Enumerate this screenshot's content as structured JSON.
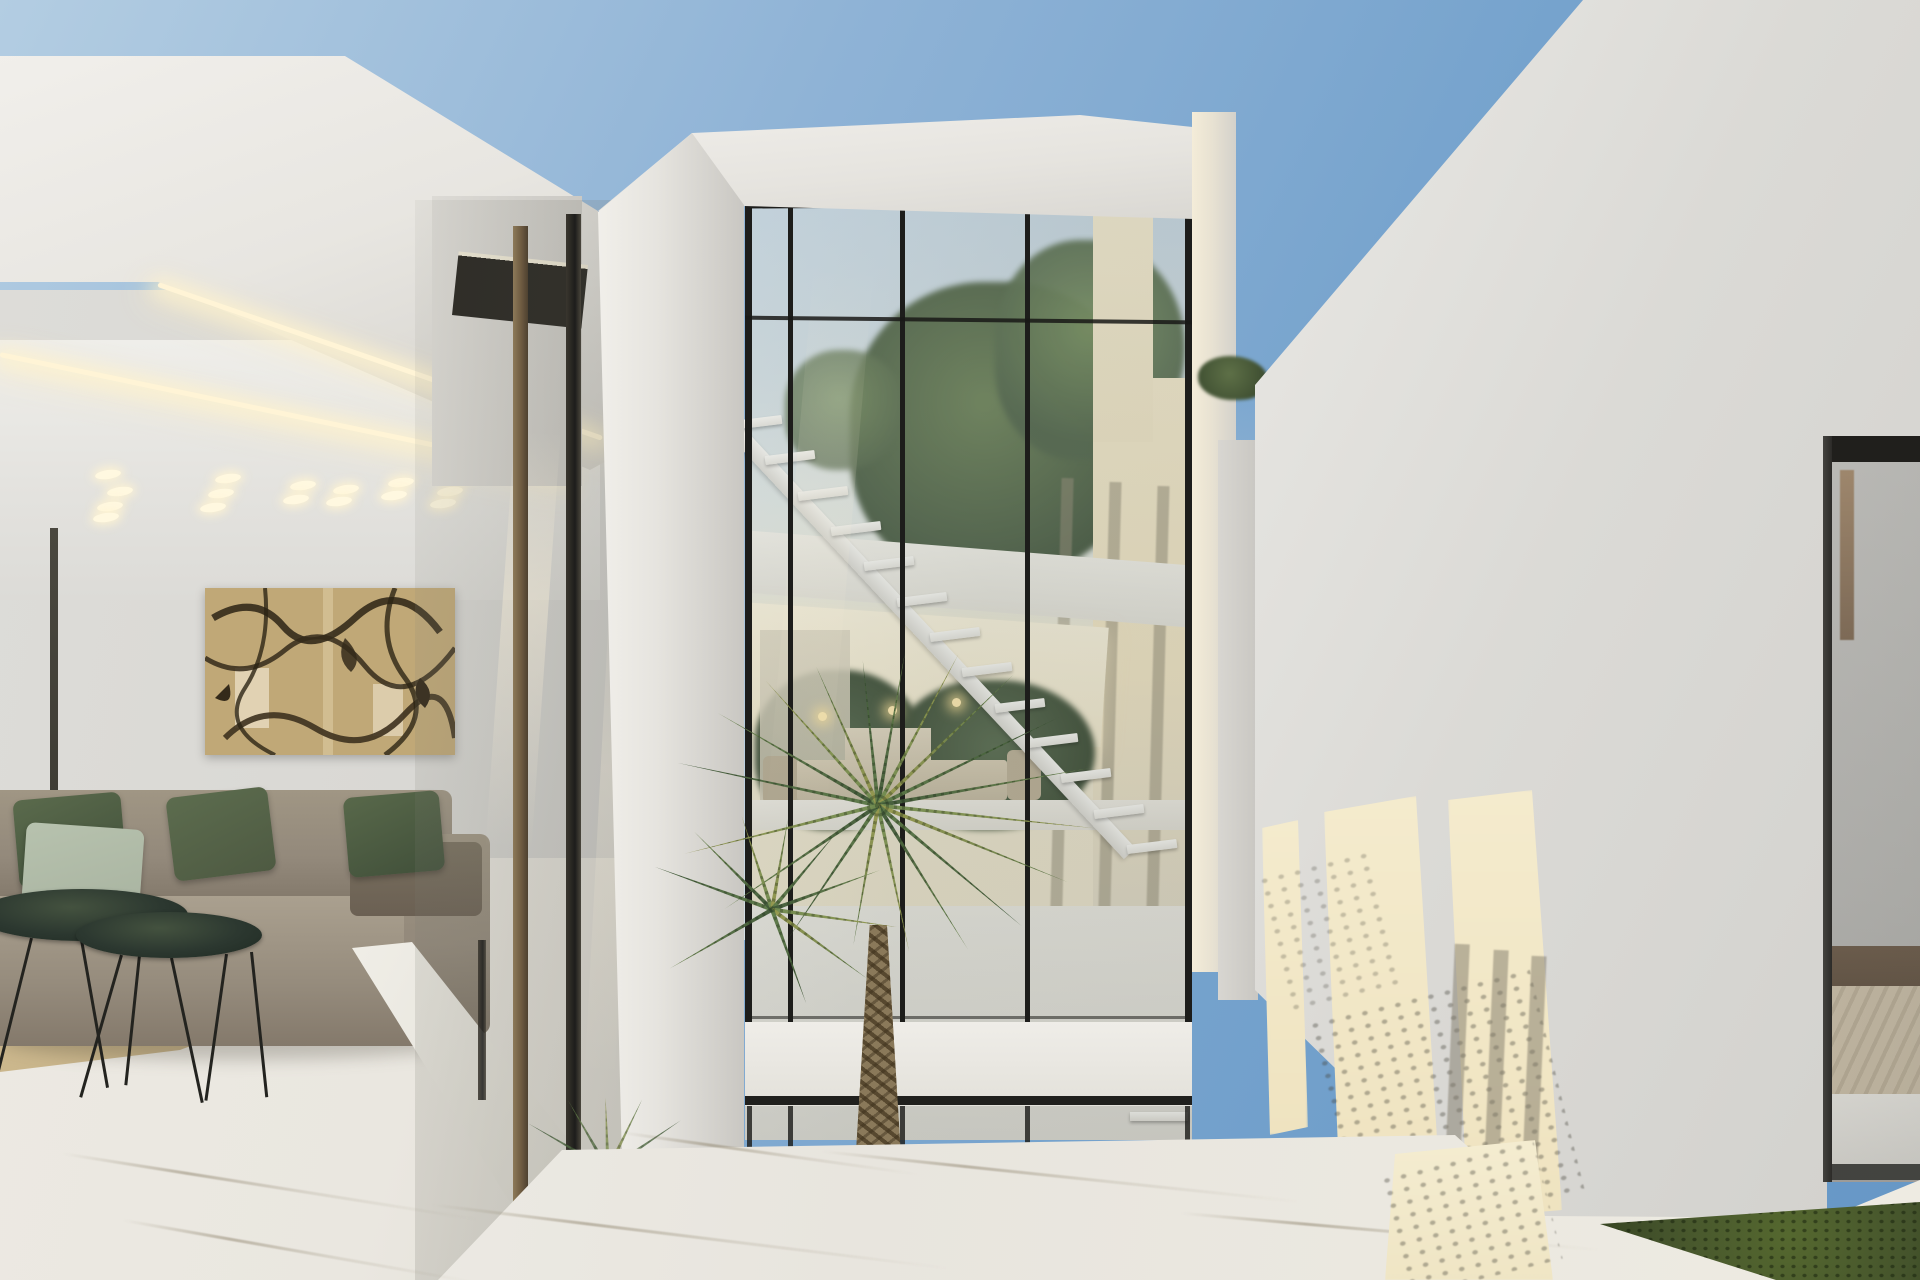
{
  "meta": {
    "title": "Architectural rendering — modern white villa with double-height glass atrium at dusk",
    "width": 1920,
    "height": 1280,
    "elements": {
      "sky": "clear evening sky, deeper blue upper right",
      "left_block": "open-air living lounge under deep white canopy with LED cove lighting",
      "painting": "abstract splatter artwork in tan and dark brown",
      "sofa": "taupe sectional sofa with olive and sage pillows",
      "coffee_tables": "two oval dark-green marble tables on wire hairpin legs",
      "rug": "tan area rug on white marble floor",
      "atrium": "double-height glazed stair tower with black mullions and floating white staircase",
      "courtyard": "sunken patio with fan palm, gravel bed and lower stair",
      "right_wall": "white volume with warm sun patches and foliage shadows",
      "bedroom": "glimpse of bedroom with beige quilted duvet behind glass",
      "view": "dusk landscape with olive hills seen through left opening"
    }
  },
  "palette": {
    "sky_top": "#6697c6",
    "sky_mid": "#a7c3dc",
    "sky_horizon": "#e9ecea",
    "white_lit": "#f0eee9",
    "white_shade": "#d9d8d4",
    "wall_grey": "#d2d1cd",
    "cream_sun": "#f4ebcd",
    "warm_glow": "#fff4d6",
    "interior_cream": "#efe6c9",
    "mullion": "#1d1d1b",
    "bronze": "#6e5b41",
    "glass_tint": "rgba(120,130,122,0.18)",
    "marble": "#eae7e0",
    "marble_vein": "#b9b1a0",
    "rug": "#c5b188",
    "sofa": "#93897b",
    "sofa_dark": "#7e7467",
    "pillow_olive": "#4e5a42",
    "pillow_olive_dark": "#41503a",
    "pillow_sage": "#a9b4a1",
    "cushion_brown": "#6b6053",
    "table_top": "#2c3830",
    "painting_base": "#c0a877",
    "painting_dark": "#342a1a",
    "painting_light": "#e8dcc2",
    "palm_green": "#5d7a48",
    "palm_dark": "#3f5838",
    "palm_mid": "#6f8a50",
    "palm_yellow": "#96984e",
    "trunk": "#8a795a",
    "trunk_dark": "#57482f",
    "tree_muted": "#4c5f45",
    "tree_dark": "#3a4c36",
    "dusk_sky": "#f0ead6",
    "hills": "#716b50",
    "grass": "#45542c",
    "gravel": "#36362d",
    "bed_duvet": "#beb098",
    "bed_frame": "#4e3c2b"
  },
  "ceiling_spotlights": [
    {
      "x": 95,
      "y": 470
    },
    {
      "x": 107,
      "y": 487
    },
    {
      "x": 97,
      "y": 502
    },
    {
      "x": 93,
      "y": 513
    },
    {
      "x": 215,
      "y": 474
    },
    {
      "x": 208,
      "y": 489
    },
    {
      "x": 200,
      "y": 503
    },
    {
      "x": 290,
      "y": 481
    },
    {
      "x": 283,
      "y": 495
    },
    {
      "x": 333,
      "y": 485
    },
    {
      "x": 326,
      "y": 497
    },
    {
      "x": 388,
      "y": 478
    },
    {
      "x": 381,
      "y": 491
    },
    {
      "x": 437,
      "y": 487
    },
    {
      "x": 430,
      "y": 499
    },
    {
      "x": 452,
      "y": 470
    }
  ],
  "stair": {
    "x1": 740,
    "y1": 428,
    "x2": 1135,
    "y2": 852,
    "treads": 13,
    "tread_w": 50,
    "tread_h": 9
  },
  "lower_steps": {
    "x": 1058,
    "y": 1052,
    "count": 4,
    "dx": 24,
    "dy": 20,
    "w": 58,
    "h": 9
  },
  "tower": {
    "glass_left": 745,
    "glass_right": 1192,
    "glass_top": 206,
    "mullions_x": [
      788,
      900,
      1025
    ],
    "transoms_y": [
      318
    ],
    "pendants": [
      {
        "x": 818,
        "y": 712
      },
      {
        "x": 888,
        "y": 706
      },
      {
        "x": 952,
        "y": 698
      }
    ]
  },
  "mullion_shadow_stripes": [
    {
      "x": 1056,
      "y": 478,
      "h": 430
    },
    {
      "x": 1104,
      "y": 482,
      "h": 426
    },
    {
      "x": 1152,
      "y": 486,
      "h": 422
    }
  ],
  "railing_shadow_stripes": [
    {
      "x": 1449,
      "y": 944,
      "h": 266
    },
    {
      "x": 1488,
      "y": 950,
      "h": 262
    },
    {
      "x": 1526,
      "y": 956,
      "h": 256
    }
  ],
  "terrace_veins": [
    {
      "x": 60,
      "y": 1185,
      "w": 420,
      "rot": 9
    },
    {
      "x": 430,
      "y": 1235,
      "w": 520,
      "rot": 7
    },
    {
      "x": 820,
      "y": 1175,
      "w": 480,
      "rot": 6
    },
    {
      "x": 1180,
      "y": 1230,
      "w": 420,
      "rot": 5
    },
    {
      "x": 620,
      "y": 1152,
      "w": 300,
      "rot": 8
    },
    {
      "x": 120,
      "y": 1250,
      "w": 360,
      "rot": 10
    }
  ],
  "palm_clusters": [
    {
      "name": "palm-canopy-main",
      "cx": 878,
      "cy": 798,
      "fronds": [
        {
          "a": -168,
          "l": 205
        },
        {
          "a": -150,
          "l": 185
        },
        {
          "a": -132,
          "l": 168
        },
        {
          "a": -114,
          "l": 152
        },
        {
          "a": -96,
          "l": 146
        },
        {
          "a": -80,
          "l": 156
        },
        {
          "a": -62,
          "l": 172
        },
        {
          "a": -44,
          "l": 188
        },
        {
          "a": -26,
          "l": 202
        },
        {
          "a": -10,
          "l": 215
        },
        {
          "a": 6,
          "l": 218
        },
        {
          "a": 22,
          "l": 205
        },
        {
          "a": 40,
          "l": 188
        },
        {
          "a": 58,
          "l": 170
        },
        {
          "a": 78,
          "l": 150
        },
        {
          "a": 100,
          "l": 142
        },
        {
          "a": 124,
          "l": 162
        },
        {
          "a": 146,
          "l": 185
        },
        {
          "a": 166,
          "l": 200
        }
      ]
    },
    {
      "name": "palm-canopy-lower",
      "cx": 772,
      "cy": 902,
      "fronds": [
        {
          "a": -160,
          "l": 125
        },
        {
          "a": -135,
          "l": 110
        },
        {
          "a": -108,
          "l": 98
        },
        {
          "a": -80,
          "l": 92
        },
        {
          "a": -50,
          "l": 100
        },
        {
          "a": -20,
          "l": 115
        },
        {
          "a": 8,
          "l": 126
        },
        {
          "a": 36,
          "l": 118
        },
        {
          "a": 70,
          "l": 100
        },
        {
          "a": 150,
          "l": 118
        }
      ]
    },
    {
      "name": "palm-courtyard-small",
      "cx": 608,
      "cy": 1162,
      "fronds": [
        {
          "a": -150,
          "l": 92
        },
        {
          "a": -120,
          "l": 80
        },
        {
          "a": -92,
          "l": 72
        },
        {
          "a": -64,
          "l": 78
        },
        {
          "a": -34,
          "l": 88
        },
        {
          "a": -8,
          "l": 96
        },
        {
          "a": 20,
          "l": 88
        },
        {
          "a": 48,
          "l": 76
        }
      ]
    }
  ],
  "frond_colors": [
    "#5d7a48",
    "#3f5838",
    "#6f8a50",
    "#96984e"
  ]
}
